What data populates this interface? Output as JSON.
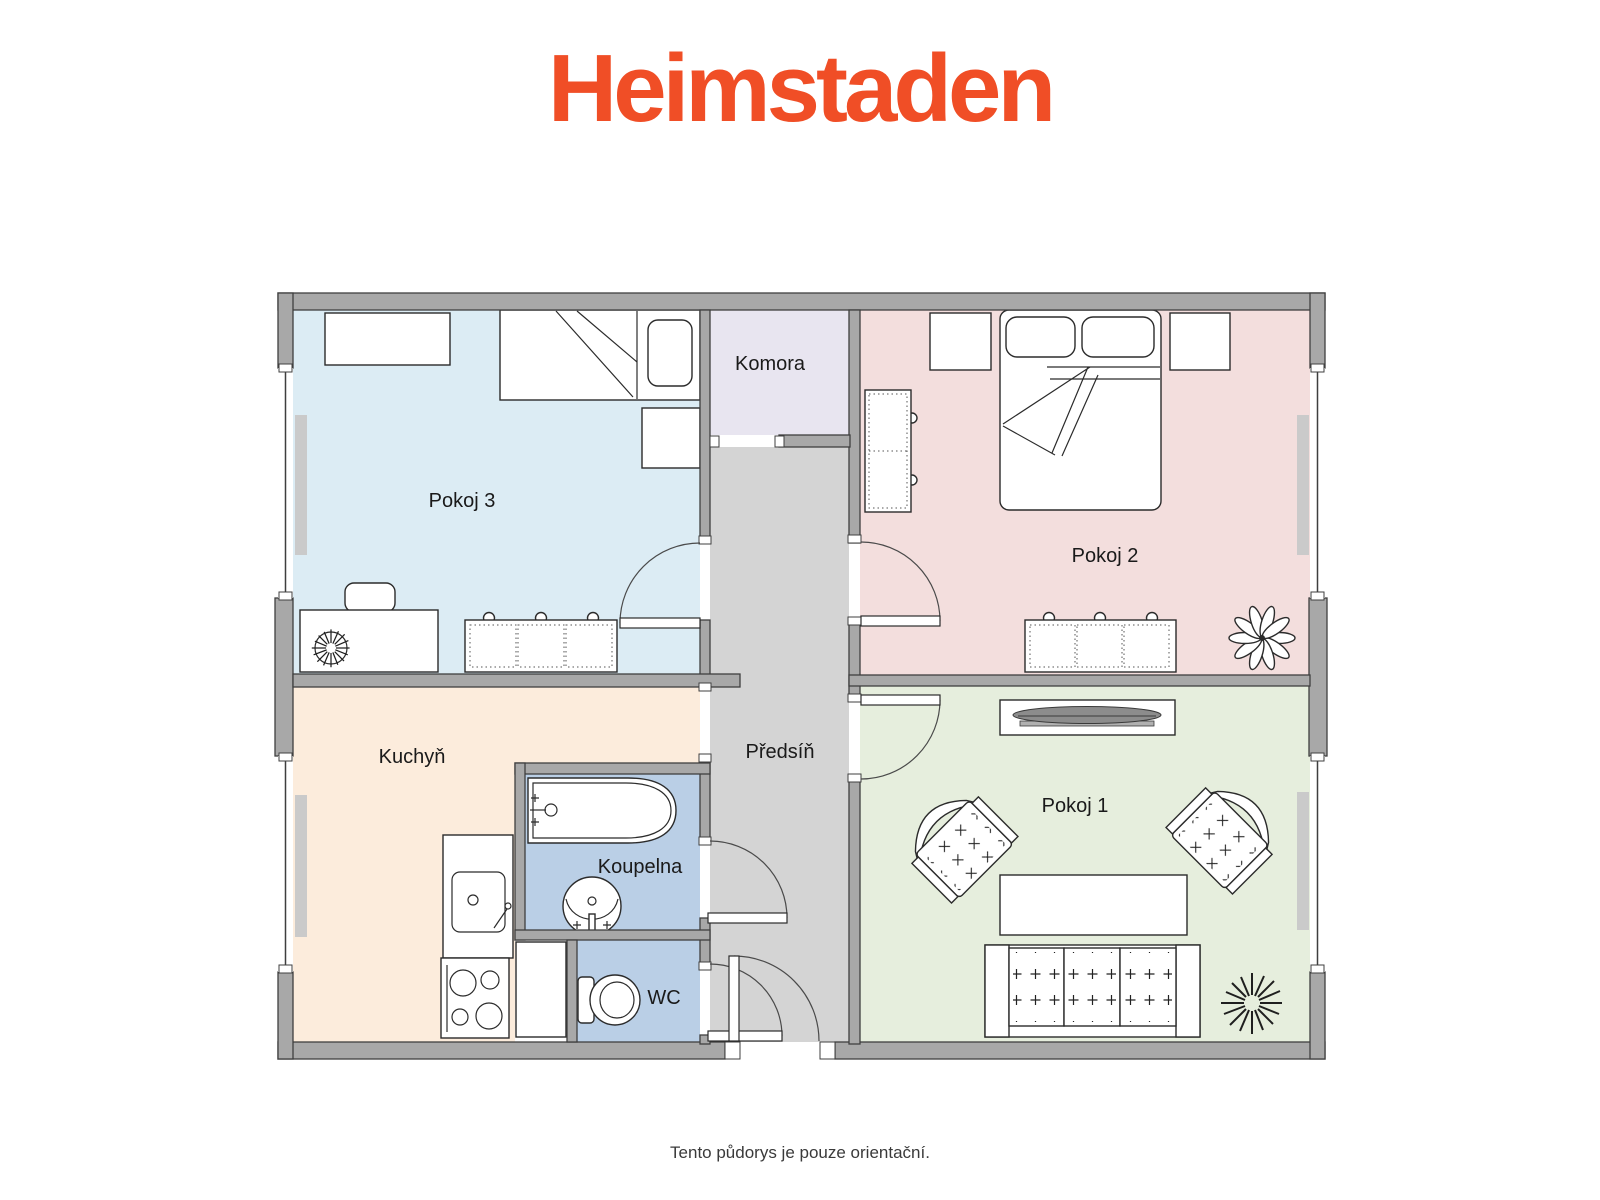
{
  "header": {
    "logo_text": "Heimstaden",
    "logo_color": "#f04e26"
  },
  "footer": {
    "disclaimer": "Tento půdorys je pouze orientační."
  },
  "floorplan": {
    "wall_color": "#a8a8a8",
    "sill_color": "#cacaca",
    "rooms": {
      "pokoj1": {
        "label": "Pokoj 1",
        "floor_color": "#e6eedd"
      },
      "pokoj2": {
        "label": "Pokoj 2",
        "floor_color": "#f3dedd"
      },
      "pokoj3": {
        "label": "Pokoj 3",
        "floor_color": "#dcecf4"
      },
      "kuchyn": {
        "label": "Kuchyň",
        "floor_color": "#fcecdc"
      },
      "komora": {
        "label": "Komora",
        "floor_color": "#e8e5f0"
      },
      "predsin": {
        "label": "Předsíň",
        "floor_color": "#d4d4d4"
      },
      "koupelna": {
        "label": "Koupelna",
        "floor_color": "#bacfe6"
      },
      "wc": {
        "label": "WC",
        "floor_color": "#bacfe6"
      }
    }
  }
}
